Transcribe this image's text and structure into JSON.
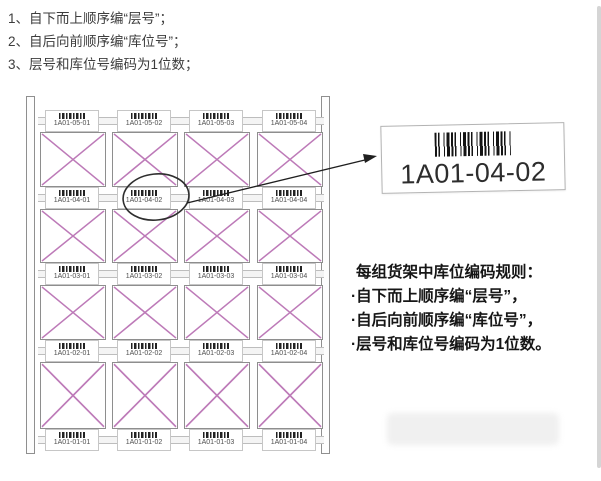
{
  "top_list": {
    "items": [
      "1、自下而上顺序编“层号”；",
      "2、自后向前顺序编“库位号”；",
      "3、层号和库位号编码为1位数；"
    ]
  },
  "rack": {
    "rows": [
      {
        "level": "5",
        "labels": [
          "1A01-05-01",
          "1A01-05-02",
          "1A01-05-03",
          "1A01-05-04"
        ]
      },
      {
        "level": "4",
        "labels": [
          "1A01-04-01",
          "1A01-04-02",
          "1A01-04-03",
          "1A01-04-04"
        ]
      },
      {
        "level": "3",
        "labels": [
          "1A01-03-01",
          "1A01-03-02",
          "1A01-03-03",
          "1A01-03-04"
        ]
      },
      {
        "level": "2",
        "labels": [
          "1A01-02-01",
          "1A01-02-02",
          "1A01-02-03",
          "1A01-02-04"
        ]
      },
      {
        "level": "1",
        "labels": [
          "1A01-01-01",
          "1A01-01-02",
          "1A01-01-03",
          "1A01-01-04"
        ]
      }
    ],
    "circled_label": "1A01-04-02"
  },
  "callout": {
    "label_text": "1A01-04-02"
  },
  "rules": {
    "title": "每组货架中库位编码规则：",
    "items": [
      "·自下而上顺序编“层号”，",
      "·自后向前顺序编“库位号”，",
      "·层号和库位号编码为1位数。"
    ]
  },
  "colors": {
    "cross_brace": "#bd7ab8",
    "rack_border": "#8e8e8e",
    "text_dark": "#3d3d3d",
    "rules_text": "#161616",
    "barcode": "#141414"
  }
}
